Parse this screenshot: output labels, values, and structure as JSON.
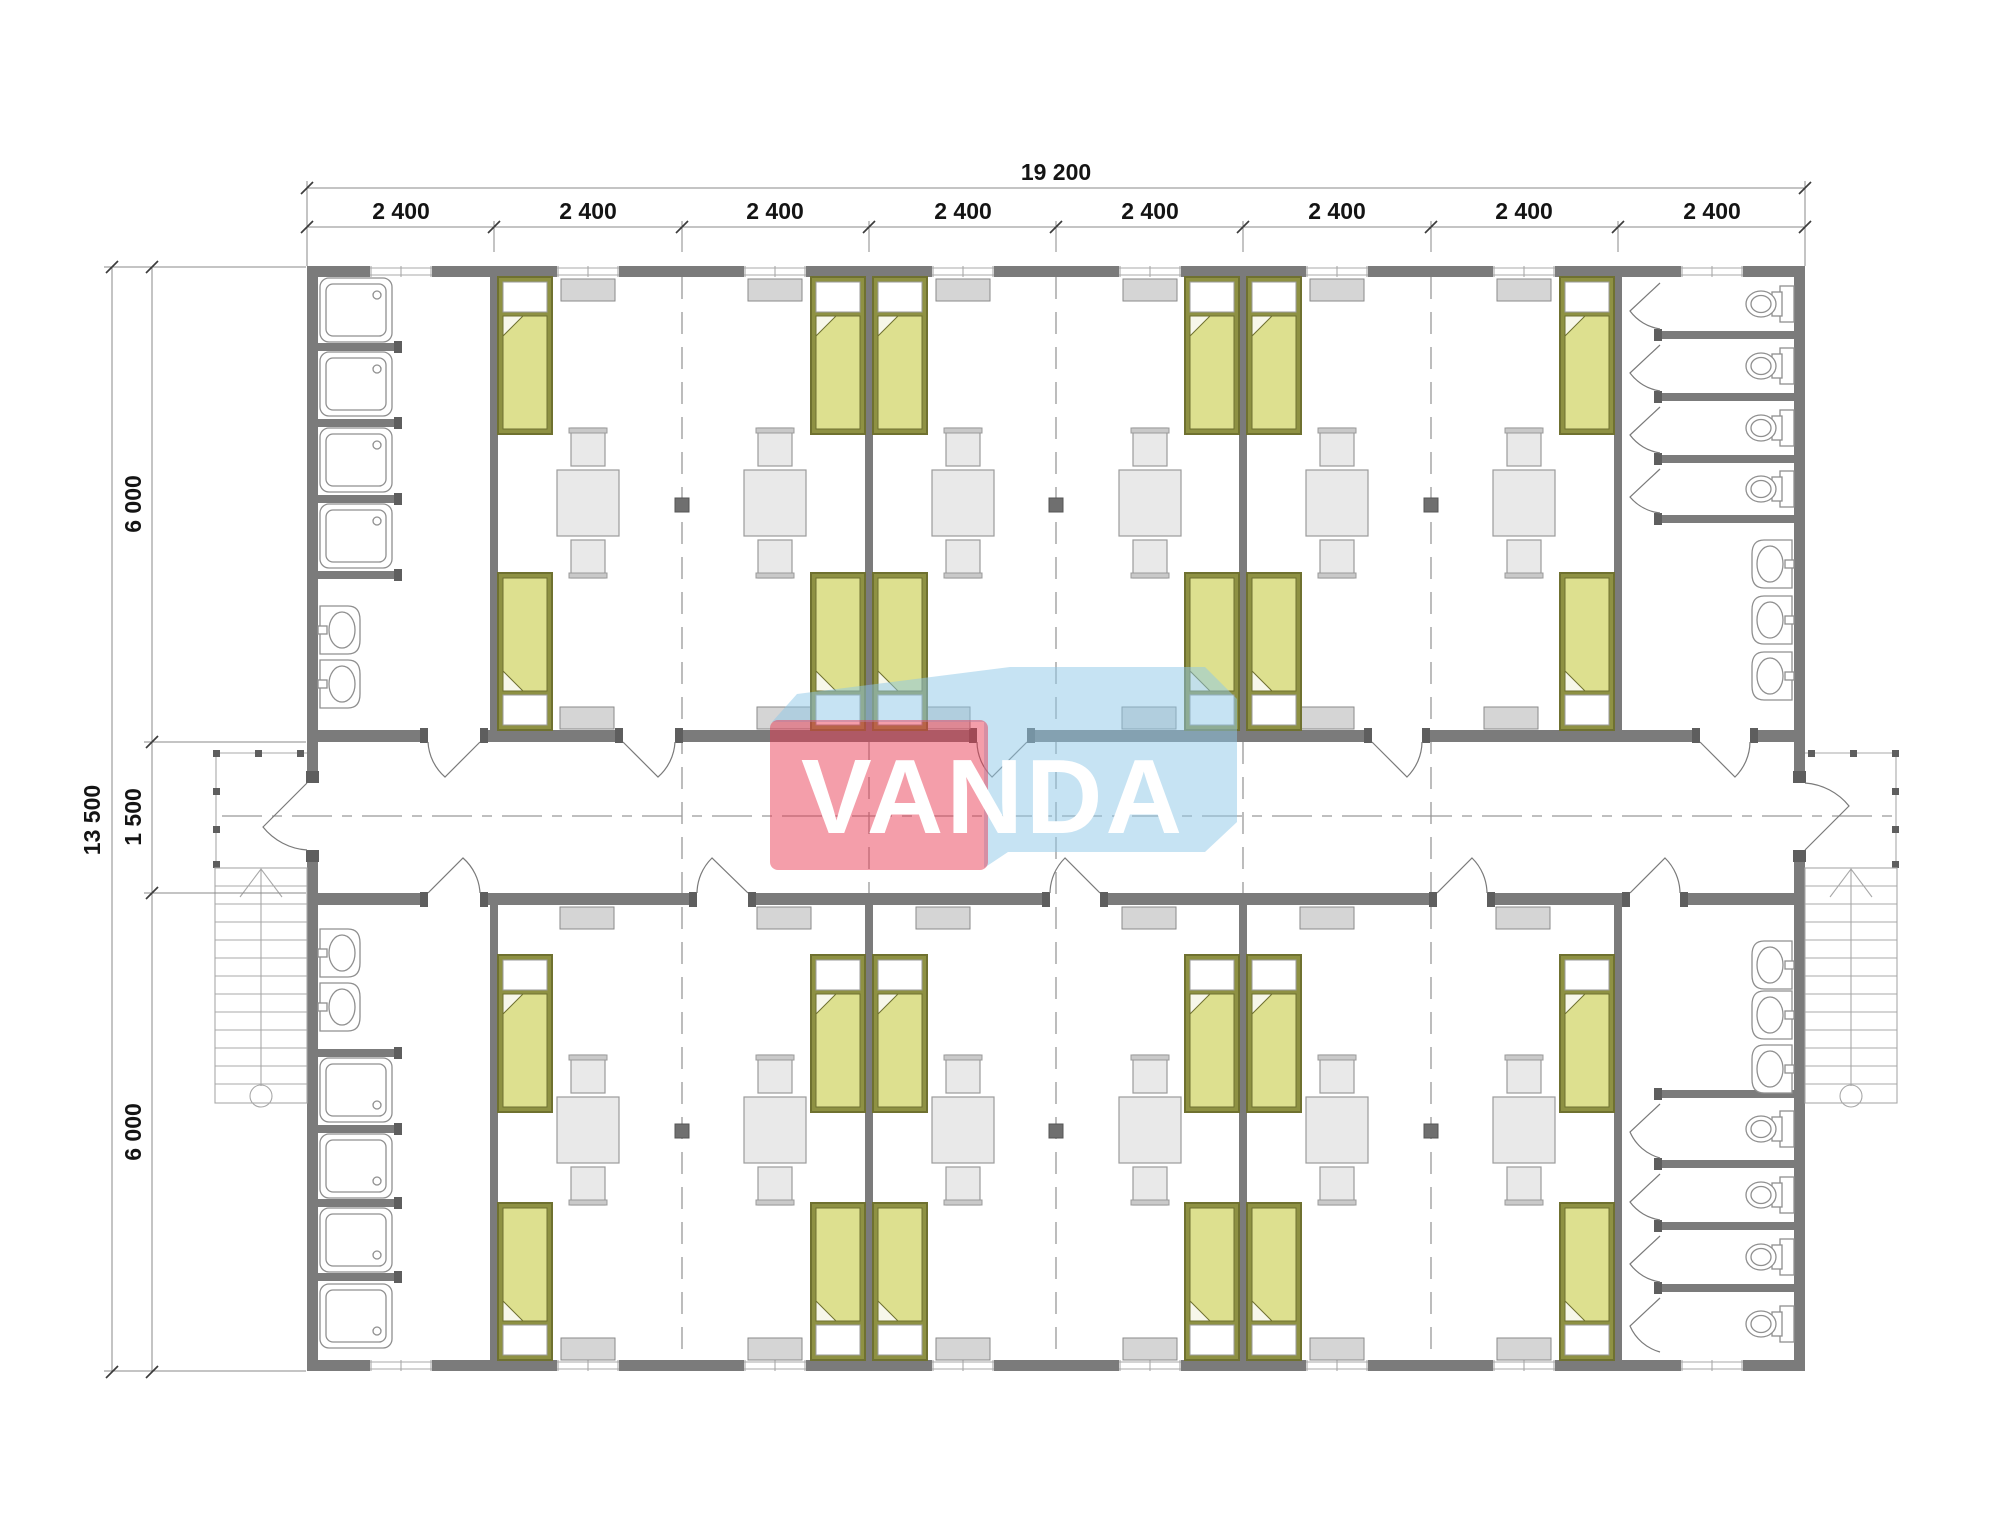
{
  "watermark": {
    "text": "VANDA"
  },
  "dimensions": {
    "top_total": "19 200",
    "top_segments": [
      "2 400",
      "2 400",
      "2 400",
      "2 400",
      "2 400",
      "2 400",
      "2 400",
      "2 400"
    ],
    "left_total": "13 500",
    "left_segments": [
      "6 000",
      "1 500",
      "6 000"
    ]
  },
  "colors": {
    "wall": "#7b7b7b",
    "wall_dark": "#5e5e5e",
    "fixture_line": "#8f8f8f",
    "thin_line": "#a8a8a8",
    "dash_line": "#999999",
    "dim_line": "#8a8a8a",
    "dim_text": "#141414",
    "bed_frame": "#8e9143",
    "bed_frame_edge": "#6f7130",
    "bed_blanket": "#dde08f",
    "bed_pillow": "#ffffff",
    "furniture_fill": "#e9e9e9",
    "furniture_edge": "#9b9b9b",
    "heater_fill": "#d5d5d5",
    "heater_edge": "#8a8a8a",
    "watermark_red": "#e8344d",
    "watermark_blue": "#8ec8e8",
    "watermark_text": "#ffffff"
  }
}
